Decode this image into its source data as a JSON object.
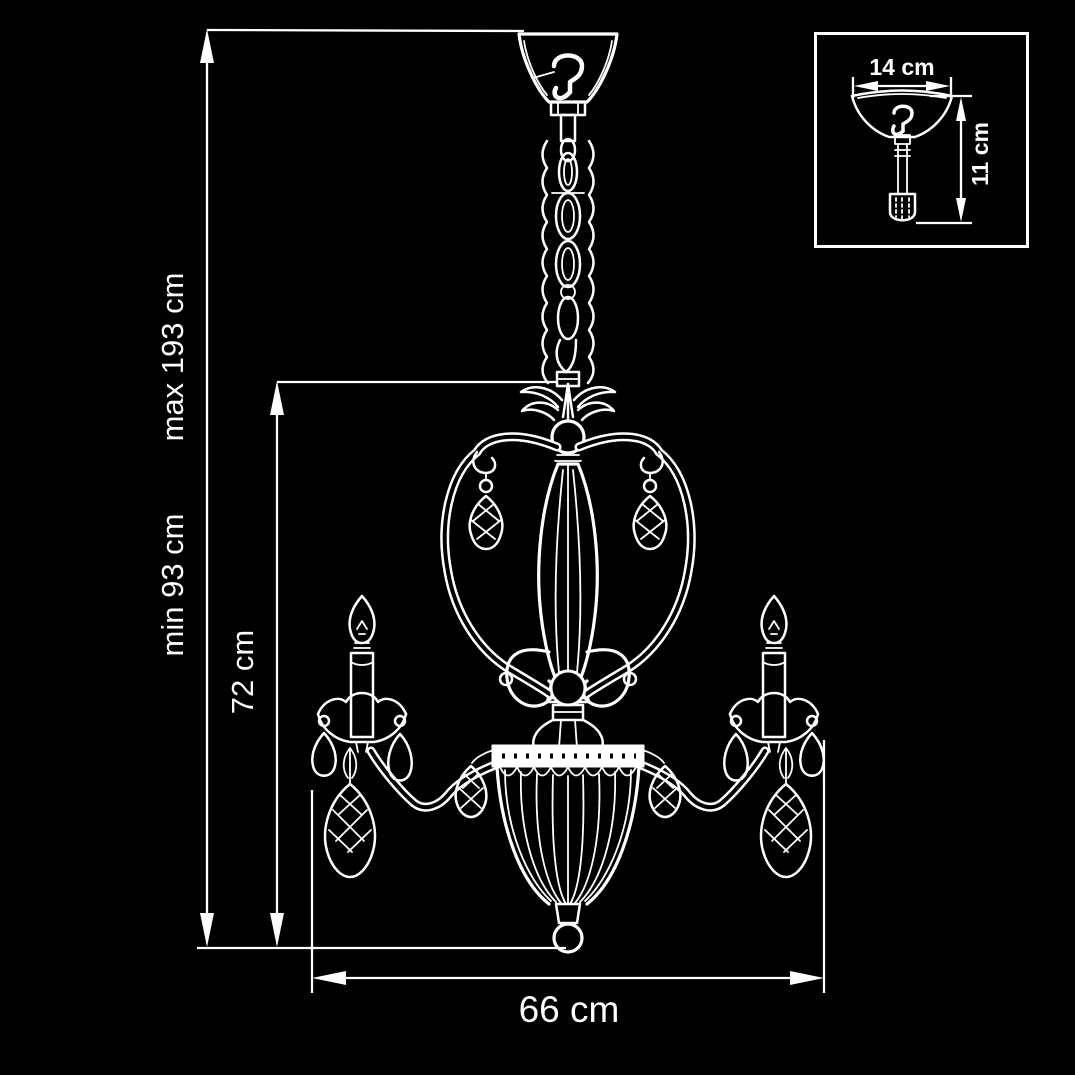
{
  "page": {
    "background": "#000000",
    "line_color": "#ffffff",
    "subject": "chandelier technical dimension drawing"
  },
  "drawing": {
    "labels": {
      "height_min": "min 93 cm",
      "height_max": "max 193 cm",
      "body_height": "72 cm",
      "width": "66 cm"
    },
    "inset": {
      "canopy_width": "14 cm",
      "canopy_drop": "11 cm"
    }
  }
}
